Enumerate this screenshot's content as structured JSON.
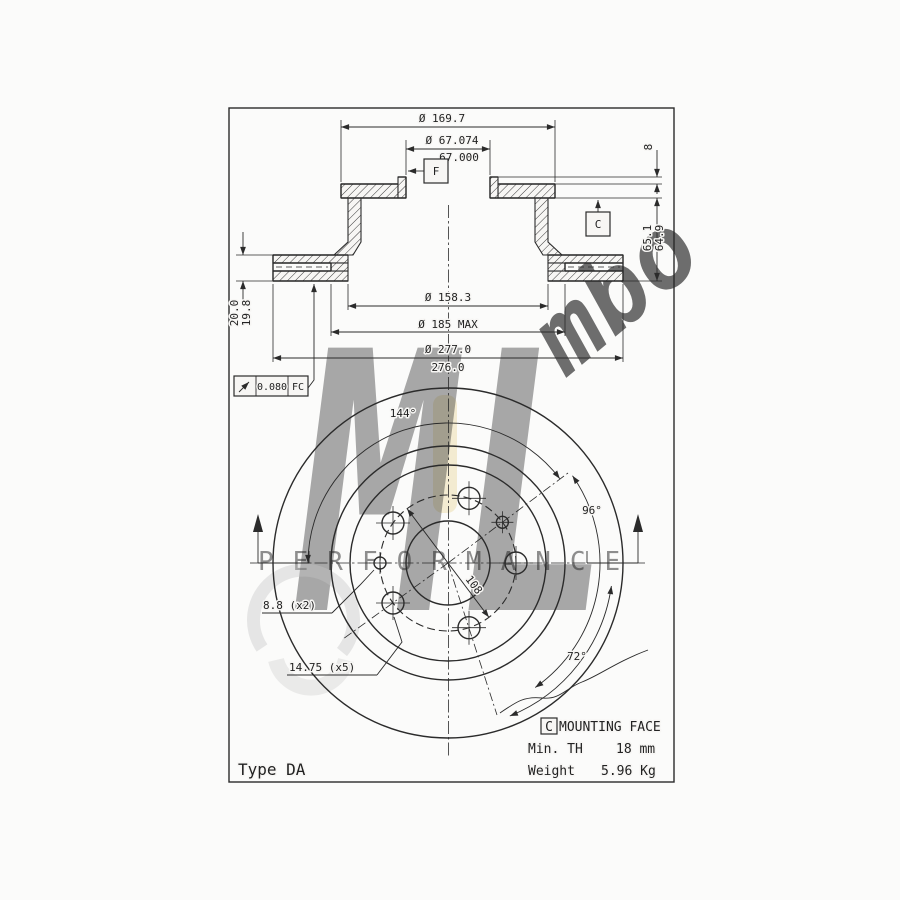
{
  "section": {
    "flange_od": "Ø 169.7",
    "bore_upper": "Ø 67.074",
    "bore_lower": "67.000",
    "datum_f": "F",
    "datum_c": "C",
    "pilot_step": "8",
    "height_upper": "65.1",
    "height_lower": "64.9",
    "thickness_upper": "20.0",
    "thickness_lower": "19.8",
    "hat_od": "Ø 158.3",
    "braking_inner": "Ø 185 MAX",
    "outer_upper": "Ø 277.0",
    "outer_lower": "276.0",
    "runout_value": "0.080",
    "runout_datum": "FC"
  },
  "face": {
    "angle_small": "144°",
    "angle_mid": "96°",
    "angle_bolt": "72°",
    "bolt_circle": "108",
    "small_holes": "8.8 (x2)",
    "bolt_holes": "14.75 (x5)"
  },
  "notes": {
    "type_label": "Type DA",
    "datum_ref": "C",
    "title": "MOUNTING FACE",
    "min_th_label": "Min. TH",
    "min_th_value": "18 mm",
    "weight_label": "Weight",
    "weight_value": "5.96 Kg"
  },
  "watermark": {
    "logo": "ML",
    "tagline": "PERFORMANCE",
    "script": "mbo"
  },
  "colors": {
    "ink": "#2b2b2b",
    "paper": "#f7f6f4",
    "gray": "#c3c3c3",
    "yellow": "#ecdfae"
  }
}
